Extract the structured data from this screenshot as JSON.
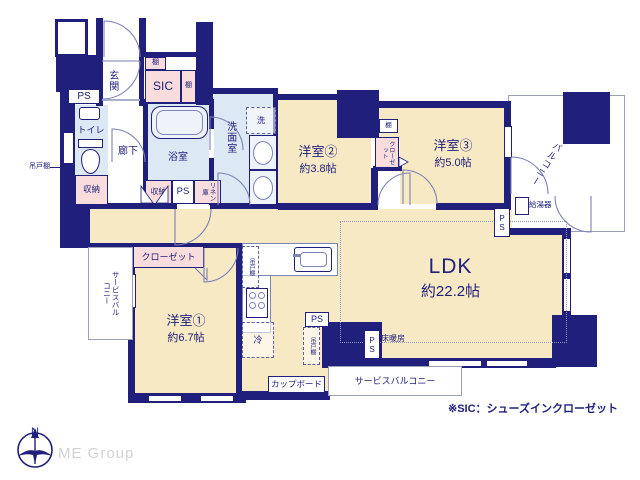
{
  "labels": {
    "genkan": "玄関",
    "sic": "SIC",
    "shelf": "棚",
    "toilet": "トイレ",
    "hallway": "廊下",
    "bath": "浴室",
    "washroom": "洗面室",
    "storage": "収納",
    "ps": "PS",
    "linen": "リネン庫",
    "hanging_shelf": "吊戸棚",
    "closet": "クローゼット",
    "washer": "洗",
    "fridge": "冷",
    "cupboard": "カップボード",
    "water_heater": "給湯器",
    "balcony": "バルコニー",
    "service_balcony": "サービスバルコニー",
    "floor_heating": "床暖房"
  },
  "rooms": {
    "room1": {
      "name": "洋室①",
      "size": "約6.7帖"
    },
    "room2": {
      "name": "洋室②",
      "size": "約3.8帖"
    },
    "room3": {
      "name": "洋室③",
      "size": "約5.0帖"
    },
    "ldk": {
      "name": "LDK",
      "size": "約22.2帖"
    }
  },
  "footer": {
    "note": "※SIC：シューズインクローゼット",
    "brand": "ME Group",
    "compass_north": "N"
  },
  "colors": {
    "wall": "#20207c",
    "room_cream": "#f8e9c5",
    "wet_blue": "#dce9f5",
    "closet_pink": "#f9dcdc",
    "text": "#20207c",
    "brand_gray": "#d2d2d2"
  }
}
